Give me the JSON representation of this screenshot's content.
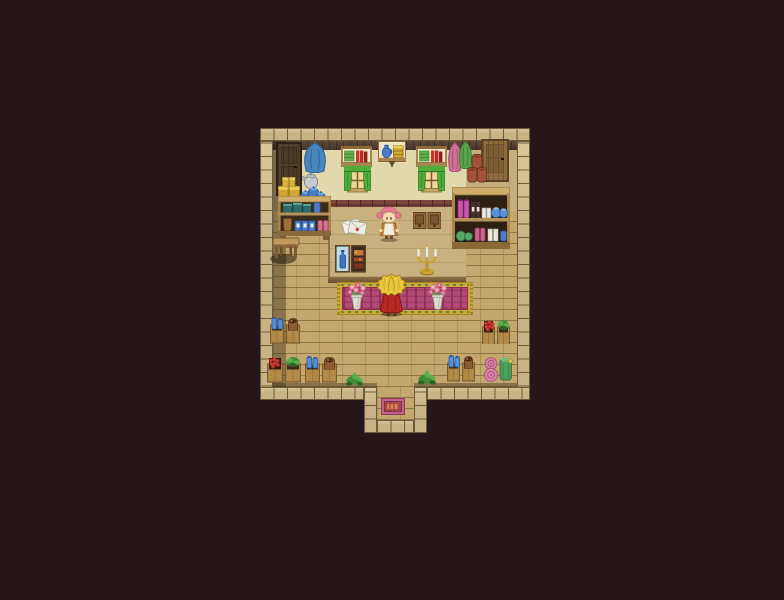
{
  "scene": {
    "width": 784,
    "height": 600,
    "description": "rpg-shop-interior-map",
    "palette": {
      "bg": "#251719",
      "stone_face": "#c8b286",
      "stone_line": "#6e5b3e",
      "stone_hi": "#dcc89c",
      "beam": "#46352a",
      "beam_hi": "#5f4a38",
      "wall_tan": "#c4ae7d",
      "wall_tan_dark": "#ac9669",
      "wall_cream": "#e1d8ad",
      "band_brick": "#7a453b",
      "band_seam": "#4e2a25",
      "floor": "#c3a76d",
      "floor_seam": "#8f7848",
      "platform": "#c9b07f",
      "platform_seam": "#ab9160",
      "platform_edge": "#6b4e30",
      "platform_edge_hi": "#8d7046",
      "shadow": "rgba(32,20,12,0.35)",
      "wood_dark": "#7c5c34",
      "wood_mid": "#a8854c",
      "wood_light": "#cfae6c",
      "wood_frame": "#8a6838",
      "door_dark_face": "#55412a",
      "door_dark_frame": "#2e2014",
      "door_light_face": "#8f6c3d",
      "door_light_frame": "#5c4124",
      "cloak_blue": "#4a86bc",
      "cloak_blue_dark": "#2e5f93",
      "cloak_pink": "#cc7292",
      "cloak_pink_dark": "#a84e72",
      "cloak_green": "#5aa44e",
      "cloak_green_dark": "#3c7c36",
      "book_green": "#63b04a",
      "book_red": "#cc3428",
      "book_red_dark": "#8e1f1a",
      "shelf_paper": "#f2ead0",
      "curtain": "#4fae3a",
      "curtain_dark": "#2f7c22",
      "pane": "#eed894",
      "window_frame": "#7c5a2e",
      "sill": "#c8a662",
      "jug_blue": "#4a7cc8",
      "jug_blue_dark": "#2c549c",
      "box_gold": "#cfa732",
      "box_gold_dark": "#8c6c14",
      "box_gold_hi": "#e8cc58",
      "gift_yellow": "#d6b238",
      "gift_dark": "#96761a",
      "kettle": "#c6cacc",
      "kettle_dark": "#7e8488",
      "keeper_hair": "#e5798f",
      "skin": "#f8d8ae",
      "apron": "#f2eedd",
      "dress": "#c27a2e",
      "player_hair": "#eac83e",
      "player_hair_dark": "#a07c14",
      "cape": "#b62823",
      "cape_dark": "#841414",
      "carpet_gold": "#c9a93e",
      "carpet_gold_dark": "#a8881e",
      "carpet_pink": "#b34b78",
      "carpet_red": "#8c2f50",
      "carpet_green": "#3f7a2e",
      "mat_pink": "#c2638f",
      "mat_red": "#a84646",
      "mat_orange": "#d88a46",
      "candle_gold": "#caa22e",
      "candle_gold_dark": "#8f7420",
      "candle_wax": "#f2f2e6",
      "envelope": "#f4f2e6",
      "envelope_line": "#a8a492",
      "seal_red": "#c03030",
      "vase": "#dedcd0",
      "vase_dark": "#9a988a",
      "flower_pink": "#ee8fa8",
      "flower_deep": "#d95f84",
      "leaf": "#56a24a",
      "crate_wood": "#b08a46",
      "crate_frame": "#7c5c2c",
      "crate_hole": "#3c2a16",
      "bottle_blue": "#5490d8",
      "bottle_blue_dark": "#2c5ca0",
      "berry": "#c03028",
      "berry_hi": "#e86050",
      "sack": "#8a5c30",
      "sack_dark": "#5c3a1c",
      "sack_red": "#a2523a",
      "sack_red_dark": "#6e3524",
      "plant_green": "#3f8e37",
      "plant_green_hi": "#5cb04a",
      "plant_dark": "#2c6424",
      "roll_pink": "#d884a8",
      "roll_pink_dark": "#a8507c",
      "roll_green": "#4f9e5c",
      "roll_green_dark": "#2e7440",
      "roll_tie": "#d8c040",
      "potion_pink": "#c858aa",
      "potion_dark": "#44332a",
      "potion_white": "#eceade",
      "potion_green": "#58a868",
      "pot_blue": "#5590d8",
      "teal_goods": "#2f6b6b",
      "teal_hi": "#5ba8a2",
      "boots_pink": "#d4748c",
      "display_bg_blue": "#bcdce4",
      "display_bg_dark": "#3c2a1c",
      "display_orange": "#c07c34",
      "display_red": "#a04828",
      "feet": "#5a3c22"
    },
    "layers": [
      {
        "name": "wall-top-beam",
        "type": "beam",
        "x": 273,
        "y": 141,
        "w": 244,
        "h": 9,
        "inter": false
      },
      {
        "name": "wall-left",
        "type": "wall",
        "variant": "wall_tan_dark",
        "x": 273,
        "y": 150,
        "w": 27,
        "h": 61,
        "inter": false
      },
      {
        "name": "wall-center",
        "type": "wall",
        "variant": "wall_cream",
        "x": 300,
        "y": 150,
        "w": 166,
        "h": 50,
        "inter": false
      },
      {
        "name": "wall-right",
        "type": "wall",
        "variant": "wall_tan",
        "x": 466,
        "y": 150,
        "w": 51,
        "h": 61,
        "inter": false
      },
      {
        "name": "wall-brick-band",
        "type": "band",
        "x": 300,
        "y": 200,
        "w": 166,
        "h": 11,
        "inter": false
      },
      {
        "name": "shop-floor",
        "type": "floor",
        "x": 273,
        "y": 211,
        "w": 244,
        "h": 176,
        "inter": true
      },
      {
        "name": "alcove-floor",
        "type": "floor",
        "x": 377,
        "y": 387,
        "w": 37,
        "h": 33,
        "inter": true
      },
      {
        "name": "counter-platform",
        "type": "platform",
        "x": 328,
        "y": 207,
        "w": 138,
        "h": 70,
        "inter": true
      },
      {
        "name": "counter-platform-edge",
        "type": "platformEdge",
        "x": 328,
        "y": 277,
        "w": 138,
        "h": 6,
        "inter": false
      },
      {
        "name": "floor-bottom-shadow-left",
        "type": "shadowbox",
        "x": 273,
        "y": 383,
        "w": 104,
        "h": 4,
        "inter": false
      },
      {
        "name": "floor-bottom-shadow-right",
        "type": "shadowbox",
        "x": 414,
        "y": 383,
        "w": 103,
        "h": 4,
        "inter": false
      },
      {
        "name": "left-wall-shadow",
        "type": "shadowbox",
        "x": 273,
        "y": 141,
        "w": 13,
        "h": 246,
        "inter": false
      },
      {
        "name": "border-top",
        "type": "stones",
        "x": 260,
        "y": 128,
        "w": 270,
        "h": 13,
        "inter": false
      },
      {
        "name": "border-left",
        "type": "stones",
        "x": 260,
        "y": 141,
        "w": 13,
        "h": 259,
        "inter": false
      },
      {
        "name": "border-right",
        "type": "stones",
        "x": 517,
        "y": 141,
        "w": 13,
        "h": 259,
        "inter": false
      },
      {
        "name": "border-bottom-left",
        "type": "stones",
        "x": 260,
        "y": 387,
        "w": 104,
        "h": 13,
        "inter": false
      },
      {
        "name": "border-bottom-right",
        "type": "stones",
        "x": 427,
        "y": 387,
        "w": 103,
        "h": 13,
        "inter": false
      },
      {
        "name": "alcove-wall-left",
        "type": "stones",
        "x": 364,
        "y": 387,
        "w": 13,
        "h": 46,
        "inter": false
      },
      {
        "name": "alcove-wall-right",
        "type": "stones",
        "x": 414,
        "y": 387,
        "w": 13,
        "h": 46,
        "inter": false
      },
      {
        "name": "alcove-border-bottom",
        "type": "stones",
        "x": 377,
        "y": 420,
        "w": 37,
        "h": 13,
        "inter": false
      }
    ],
    "objects": [
      {
        "name": "left-wall-door",
        "type": "door",
        "variant": "dark",
        "x": 276,
        "y": 142,
        "w": 26,
        "h": 54,
        "inter": true
      },
      {
        "name": "right-wall-door",
        "type": "door",
        "variant": "light",
        "x": 481,
        "y": 139,
        "w": 28,
        "h": 43,
        "inter": true
      },
      {
        "name": "hanging-cloak-blue",
        "type": "cloak",
        "variant": "blue",
        "x": 302,
        "y": 141,
        "w": 26,
        "h": 32,
        "inter": false
      },
      {
        "name": "bookshelf-left",
        "type": "bookshelf",
        "x": 341,
        "y": 146,
        "w": 31,
        "h": 21,
        "inter": true
      },
      {
        "name": "window-left",
        "type": "window",
        "x": 344,
        "y": 166,
        "w": 27,
        "h": 29,
        "inter": false
      },
      {
        "name": "wall-shelf-jug-box",
        "type": "wallshelf",
        "x": 378,
        "y": 141,
        "w": 28,
        "h": 27,
        "inter": true
      },
      {
        "name": "bookshelf-right",
        "type": "bookshelf",
        "x": 416,
        "y": 146,
        "w": 31,
        "h": 21,
        "inter": true
      },
      {
        "name": "window-right",
        "type": "window",
        "x": 418,
        "y": 166,
        "w": 27,
        "h": 29,
        "inter": false
      },
      {
        "name": "hanging-cloak-pink",
        "type": "cloak",
        "variant": "pink",
        "x": 447,
        "y": 141,
        "w": 16,
        "h": 31,
        "inter": false
      },
      {
        "name": "hanging-cloak-green",
        "type": "cloak",
        "variant": "green",
        "x": 458,
        "y": 140,
        "w": 15,
        "h": 29,
        "inter": false
      },
      {
        "name": "sack-stack",
        "type": "sacks",
        "x": 467,
        "y": 151,
        "w": 20,
        "h": 32,
        "inter": true
      },
      {
        "name": "gift-boxes",
        "type": "gifts",
        "x": 278,
        "y": 177,
        "w": 22,
        "h": 23,
        "inter": true
      },
      {
        "name": "kettle",
        "type": "kettle",
        "x": 301,
        "y": 170,
        "w": 18,
        "h": 20,
        "inter": true
      },
      {
        "name": "blue-jar-cluster",
        "type": "jars",
        "x": 299,
        "y": 182,
        "w": 27,
        "h": 22,
        "inter": true
      },
      {
        "name": "left-goods-shelf",
        "type": "shelfunit",
        "x": 278,
        "y": 196,
        "w": 53,
        "h": 44,
        "inter": true
      },
      {
        "name": "stool",
        "type": "stool",
        "x": 270,
        "y": 234,
        "w": 32,
        "h": 30,
        "inter": true
      },
      {
        "name": "letters",
        "type": "letters",
        "x": 342,
        "y": 214,
        "w": 26,
        "h": 24,
        "inter": true
      },
      {
        "name": "shopkeeper",
        "type": "keeper",
        "x": 376,
        "y": 205,
        "w": 26,
        "h": 37,
        "inter": true
      },
      {
        "name": "counter-cabinets",
        "type": "cabinets",
        "x": 413,
        "y": 212,
        "w": 28,
        "h": 17,
        "inter": true
      },
      {
        "name": "display-case",
        "type": "display",
        "x": 335,
        "y": 245,
        "w": 31,
        "h": 28,
        "inter": true
      },
      {
        "name": "candelabra",
        "type": "candelabra",
        "x": 415,
        "y": 244,
        "w": 24,
        "h": 32,
        "inter": true
      },
      {
        "name": "potion-shelf",
        "type": "potionshelf",
        "x": 452,
        "y": 187,
        "w": 58,
        "h": 62,
        "inter": true
      },
      {
        "name": "carpet",
        "type": "carpet",
        "x": 337,
        "y": 282,
        "w": 136,
        "h": 33,
        "inter": true
      },
      {
        "name": "flower-vase-left",
        "type": "vase",
        "x": 346,
        "y": 282,
        "w": 21,
        "h": 32,
        "inter": true
      },
      {
        "name": "flower-vase-right",
        "type": "vase",
        "x": 427,
        "y": 282,
        "w": 21,
        "h": 32,
        "inter": true
      },
      {
        "name": "player-character",
        "type": "player",
        "x": 376,
        "y": 273,
        "w": 31,
        "h": 44,
        "inter": true
      },
      {
        "name": "crate-bottles-sack-left",
        "type": "cratepair",
        "contents": [
          "bottles",
          "sack"
        ],
        "x": 270,
        "y": 317,
        "w": 31,
        "h": 27,
        "inter": true
      },
      {
        "name": "crate-berries-plant-left",
        "type": "cratepair",
        "contents": [
          "berries",
          "plant"
        ],
        "x": 267,
        "y": 356,
        "w": 34,
        "h": 28,
        "inter": true
      },
      {
        "name": "crate-bottles-sack-mid",
        "type": "cratepair",
        "contents": [
          "bottles",
          "sack"
        ],
        "x": 305,
        "y": 356,
        "w": 33,
        "h": 28,
        "inter": true
      },
      {
        "name": "crate-berries-plant-right",
        "type": "cratepair",
        "contents": [
          "berries",
          "plant"
        ],
        "x": 482,
        "y": 319,
        "w": 29,
        "h": 25,
        "inter": true
      },
      {
        "name": "crate-bottles-sack-right",
        "type": "cratepair",
        "contents": [
          "bottles",
          "sack"
        ],
        "x": 447,
        "y": 355,
        "w": 29,
        "h": 27,
        "inter": true
      },
      {
        "name": "fabric-rolls",
        "type": "rolls",
        "x": 483,
        "y": 354,
        "w": 31,
        "h": 28,
        "inter": true
      },
      {
        "name": "floor-plant-left",
        "type": "plant",
        "x": 346,
        "y": 372,
        "w": 17,
        "h": 15,
        "inter": false
      },
      {
        "name": "floor-plant-right",
        "type": "plant",
        "x": 418,
        "y": 370,
        "w": 18,
        "h": 16,
        "inter": false
      },
      {
        "name": "entrance-doormat",
        "type": "doormat",
        "x": 381,
        "y": 398,
        "w": 24,
        "h": 17,
        "inter": true
      }
    ]
  }
}
